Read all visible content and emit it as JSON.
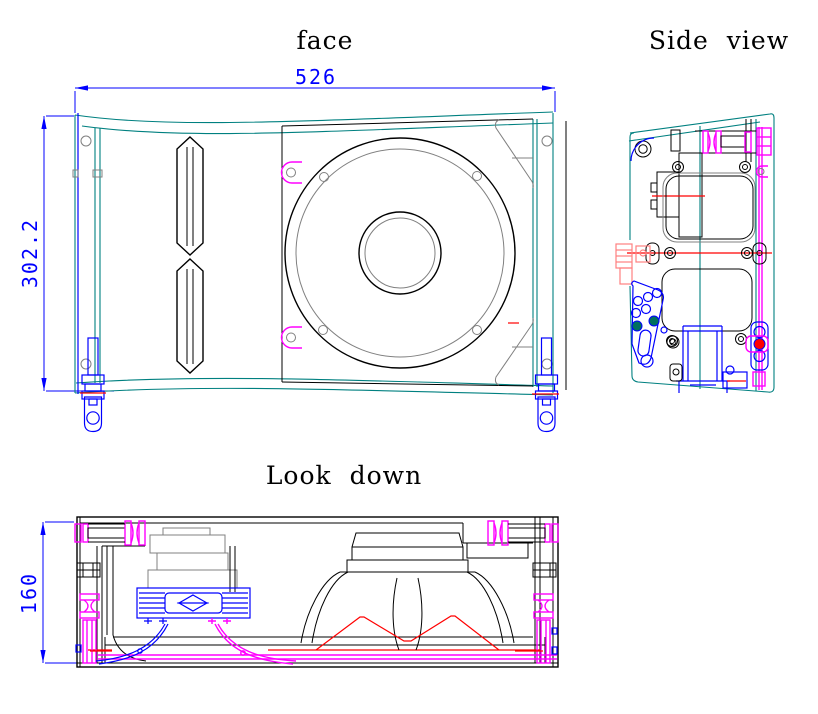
{
  "views": {
    "face": {
      "title": "face",
      "width_dim": "526",
      "height_dim": "302.2"
    },
    "side": {
      "title": "Side view"
    },
    "top": {
      "title": "Look down",
      "depth_dim": "160"
    }
  },
  "colors": {
    "background": "#ffffff",
    "drawing": "#000000",
    "secondary": "#808080",
    "cabinet-outline": "#008080",
    "dimension": "#0000ff",
    "hardware": "#ff00ff",
    "section": "#ff0000",
    "connector-pink": "#ff8080",
    "plated": "#00705f"
  }
}
